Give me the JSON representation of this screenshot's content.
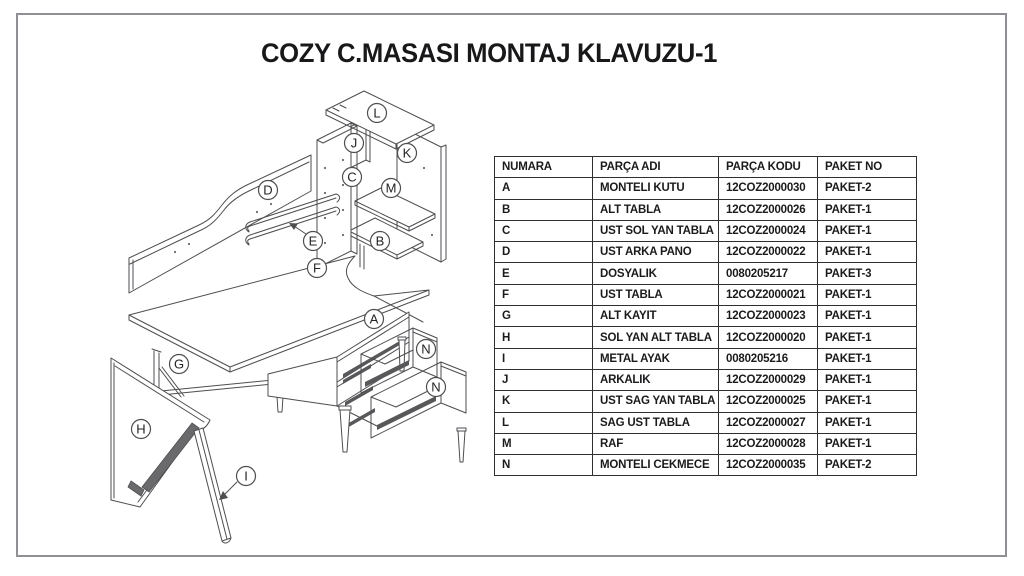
{
  "title": "COZY C.MASASI MONTAJ KLAVUZU-1",
  "table": {
    "headers": [
      "NUMARA",
      "PARÇA ADI",
      "PARÇA KODU",
      "PAKET NO"
    ],
    "rows": [
      [
        "A",
        "MONTELI KUTU",
        "12COZ2000030",
        "PAKET-2"
      ],
      [
        "B",
        "ALT TABLA",
        "12COZ2000026",
        "PAKET-1"
      ],
      [
        "C",
        "UST SOL YAN TABLA",
        "12COZ2000024",
        "PAKET-1"
      ],
      [
        "D",
        "UST ARKA PANO",
        "12COZ2000022",
        "PAKET-1"
      ],
      [
        "E",
        "DOSYALIK",
        "0080205217",
        "PAKET-3"
      ],
      [
        "F",
        "UST TABLA",
        "12COZ2000021",
        "PAKET-1"
      ],
      [
        "G",
        "ALT KAYIT",
        "12COZ2000023",
        "PAKET-1"
      ],
      [
        "H",
        "SOL YAN ALT TABLA",
        "12COZ2000020",
        "PAKET-1"
      ],
      [
        "I",
        "METAL AYAK",
        "0080205216",
        "PAKET-1"
      ],
      [
        "J",
        "ARKALIK",
        "12COZ2000029",
        "PAKET-1"
      ],
      [
        "K",
        "UST SAG YAN TABLA",
        "12COZ2000025",
        "PAKET-1"
      ],
      [
        "L",
        "SAG UST TABLA",
        "12COZ2000027",
        "PAKET-1"
      ],
      [
        "M",
        "RAF",
        "12COZ2000028",
        "PAKET-1"
      ],
      [
        "N",
        "MONTELI CEKMECE",
        "12COZ2000035",
        "PAKET-2"
      ]
    ]
  },
  "diagram": {
    "labels": [
      {
        "id": "L",
        "x": 374,
        "y": 113
      },
      {
        "id": "J",
        "x": 351,
        "y": 143
      },
      {
        "id": "K",
        "x": 404,
        "y": 153
      },
      {
        "id": "C",
        "x": 349,
        "y": 177
      },
      {
        "id": "M",
        "x": 388,
        "y": 188
      },
      {
        "id": "D",
        "x": 265,
        "y": 190
      },
      {
        "id": "E",
        "x": 310,
        "y": 241
      },
      {
        "id": "B",
        "x": 377,
        "y": 241
      },
      {
        "id": "F",
        "x": 314,
        "y": 268
      },
      {
        "id": "A",
        "x": 371,
        "y": 319
      },
      {
        "id": "N",
        "x": 423,
        "y": 349
      },
      {
        "id": "N",
        "x": 433,
        "y": 387
      },
      {
        "id": "G",
        "x": 176,
        "y": 364
      },
      {
        "id": "H",
        "x": 138,
        "y": 429
      },
      {
        "id": "I",
        "x": 243,
        "y": 476
      }
    ],
    "line_color": "#4d4e50",
    "label_color": "#232325"
  },
  "page": {
    "background": "#ffffff",
    "border_color": "#8e9093"
  }
}
